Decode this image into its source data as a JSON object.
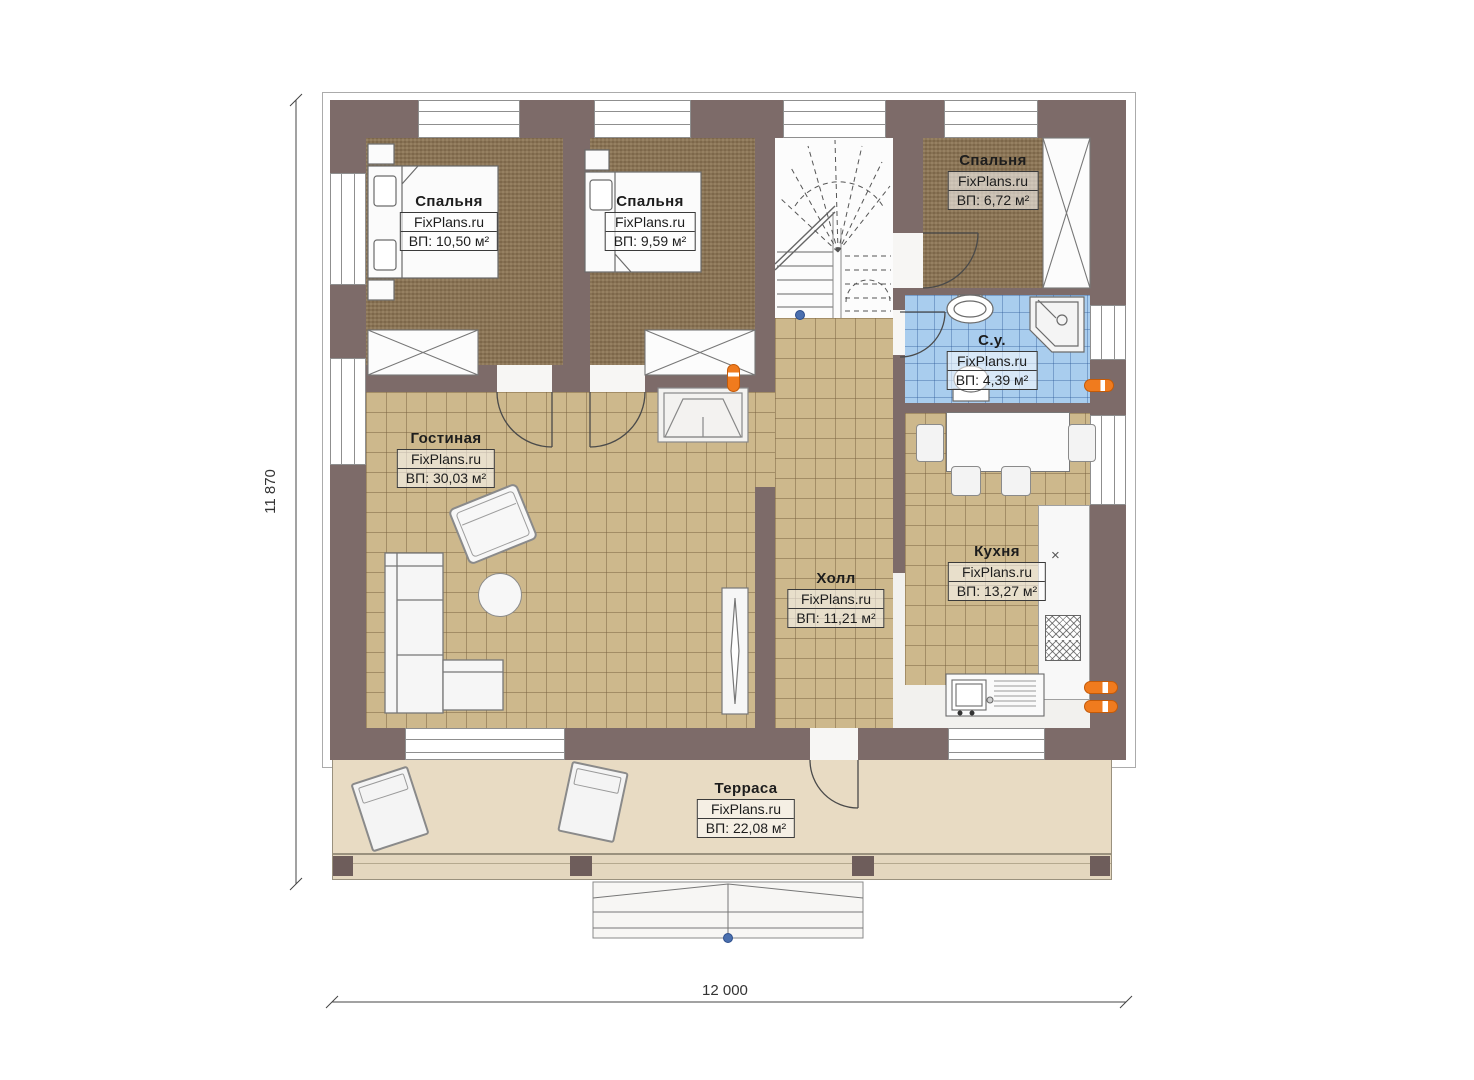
{
  "plan": {
    "rooms": [
      {
        "id": "bedroom-1",
        "name": "Спальня",
        "brand": "FixPlans.ru",
        "area": "ВП: 10,50 м²"
      },
      {
        "id": "bedroom-2",
        "name": "Спальня",
        "brand": "FixPlans.ru",
        "area": "ВП: 9,59 м²"
      },
      {
        "id": "bedroom-3",
        "name": "Спальня",
        "brand": "FixPlans.ru",
        "area": "ВП: 6,72 м²"
      },
      {
        "id": "bathroom",
        "name": "С.у.",
        "brand": "FixPlans.ru",
        "area": "ВП: 4,39 м²"
      },
      {
        "id": "living",
        "name": "Гостиная",
        "brand": "FixPlans.ru",
        "area": "ВП: 30,03 м²"
      },
      {
        "id": "hall",
        "name": "Холл",
        "brand": "FixPlans.ru",
        "area": "ВП: 11,21 м²"
      },
      {
        "id": "kitchen",
        "name": "Кухня",
        "brand": "FixPlans.ru",
        "area": "ВП: 13,27 м²"
      },
      {
        "id": "terrace",
        "name": "Терраса",
        "brand": "FixPlans.ru",
        "area": "ВП: 22,08 м²"
      }
    ],
    "dimensions": {
      "height_label": "11 870",
      "width_label": "12 000"
    },
    "symbols": {
      "vent": "×"
    },
    "colors": {
      "wall": "#7d6b69",
      "carpet": "#8d7553",
      "tile": "#cdb88c",
      "bath": "#a9cdee",
      "terrace": "#e8dbc3",
      "radiator": "#f07b1e",
      "accent_blue": "#4a6fae"
    }
  }
}
